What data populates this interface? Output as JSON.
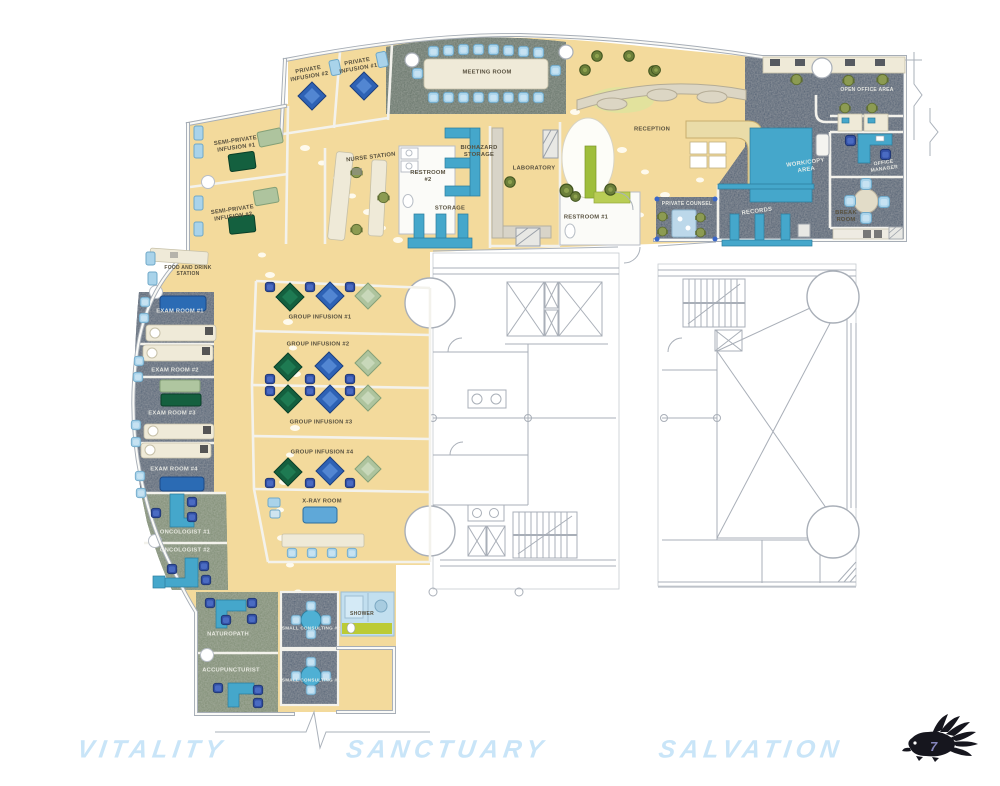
{
  "title": "Clinic Floor Plan",
  "labels": [
    {
      "id": "private-infusion-2",
      "text": "PRIVATE\nINFUSION #2",
      "x": 309,
      "y": 74,
      "rot": -10
    },
    {
      "id": "private-infusion-1",
      "text": "PRIVATE\nINFUSION #1",
      "x": 358,
      "y": 66,
      "rot": -10
    },
    {
      "id": "meeting-room",
      "text": "MEETING ROOM",
      "x": 487,
      "y": 73
    },
    {
      "id": "semi-private-infusion-1",
      "text": "SEMI-PRIVATE\nINFUSION #1",
      "x": 236,
      "y": 145,
      "rot": -8
    },
    {
      "id": "semi-private-infusion-2",
      "text": "SEMI-PRIVATE\nINFUSION #2",
      "x": 233,
      "y": 214,
      "rot": -8
    },
    {
      "id": "nurse-station",
      "text": "NURSE STATION",
      "x": 371,
      "y": 158,
      "rot": -7
    },
    {
      "id": "restroom-2",
      "text": "RESTROOM\n#2",
      "x": 428,
      "y": 177
    },
    {
      "id": "biohazard-storage",
      "text": "BIOHAZARD\nSTORAGE",
      "x": 479,
      "y": 152
    },
    {
      "id": "storage",
      "text": "STORAGE",
      "x": 450,
      "y": 209
    },
    {
      "id": "laboratory",
      "text": "LABORATORY",
      "x": 534,
      "y": 169
    },
    {
      "id": "restroom-1",
      "text": "RESTROOM #1",
      "x": 586,
      "y": 218
    },
    {
      "id": "reception",
      "text": "RECEPTION",
      "x": 652,
      "y": 130
    },
    {
      "id": "private-counsel",
      "text": "PRIVATE COUNSEL",
      "x": 687,
      "y": 204,
      "light": true,
      "size": 5
    },
    {
      "id": "records",
      "text": "RECORDS",
      "x": 757,
      "y": 212,
      "rot": -8,
      "light": true
    },
    {
      "id": "work-copy-area",
      "text": "WORK/COPY\nAREA",
      "x": 806,
      "y": 167,
      "rot": -8,
      "light": true
    },
    {
      "id": "open-office-area",
      "text": "OPEN OFFICE AREA",
      "x": 867,
      "y": 90,
      "light": true,
      "size": 5
    },
    {
      "id": "office-manager",
      "text": "OFFICE\nMANAGER",
      "x": 884,
      "y": 166,
      "rot": -8,
      "light": true,
      "size": 5
    },
    {
      "id": "break-room",
      "text": "BREAK\nROOM",
      "x": 846,
      "y": 217
    },
    {
      "id": "food-drink-station",
      "text": "FOOD AND DRINK\nSTATION",
      "x": 188,
      "y": 271,
      "size": 5
    },
    {
      "id": "exam-room-1",
      "text": "EXAM ROOM #1",
      "x": 180,
      "y": 312,
      "light": true
    },
    {
      "id": "exam-room-2",
      "text": "EXAM ROOM #2",
      "x": 175,
      "y": 371,
      "light": true
    },
    {
      "id": "exam-room-3",
      "text": "EXAM ROOM #3",
      "x": 172,
      "y": 414,
      "light": true
    },
    {
      "id": "exam-room-4",
      "text": "EXAM ROOM #4",
      "x": 174,
      "y": 470,
      "light": true
    },
    {
      "id": "oncologist-1",
      "text": "ONCOLOGIST #1",
      "x": 185,
      "y": 533,
      "light": true
    },
    {
      "id": "oncologist-2",
      "text": "ONCOLOGIST #2",
      "x": 185,
      "y": 551,
      "light": true
    },
    {
      "id": "group-infusion-1",
      "text": "GROUP INFUSION #1",
      "x": 320,
      "y": 318
    },
    {
      "id": "group-infusion-2",
      "text": "GROUP INFUSION #2",
      "x": 318,
      "y": 345
    },
    {
      "id": "group-infusion-3",
      "text": "GROUP INFUSION #3",
      "x": 321,
      "y": 423
    },
    {
      "id": "group-infusion-4",
      "text": "GROUP INFUSION #4",
      "x": 322,
      "y": 453
    },
    {
      "id": "x-ray-room",
      "text": "X-RAY ROOM",
      "x": 322,
      "y": 502
    },
    {
      "id": "naturopath",
      "text": "NATUROPATH",
      "x": 228,
      "y": 635,
      "light": true
    },
    {
      "id": "accupuncturist",
      "text": "ACCUPUNCTURIST",
      "x": 231,
      "y": 671,
      "light": true
    },
    {
      "id": "small-consulting-2",
      "text": "SMALL CONSULTING #2",
      "x": 311,
      "y": 628,
      "light": true,
      "size": 4.6
    },
    {
      "id": "small-consulting-1",
      "text": "SMALL CONSULTING #1",
      "x": 311,
      "y": 680,
      "light": true,
      "size": 4.6
    },
    {
      "id": "shower",
      "text": "SHOWER",
      "x": 362,
      "y": 614,
      "size": 5
    }
  ],
  "zone_words": [
    {
      "id": "vitality",
      "text": "VITALITY",
      "x": 152,
      "y": 750
    },
    {
      "id": "sanctuary",
      "text": "SANCTUARY",
      "x": 447,
      "y": 750
    },
    {
      "id": "salvation",
      "text": "SALVATION",
      "x": 751,
      "y": 750
    }
  ],
  "page_marker": {
    "number": "7"
  },
  "colors": {
    "floor": "#f3da9c",
    "slate": "#4e5e73",
    "sage": "#7b8a70",
    "meeting": "#5f6f63",
    "teal": "#45a7cb",
    "accent_blue": "#2e62b5",
    "dark_green": "#14603f",
    "light_green": "#b2c8a2",
    "olive": "#8c9b52",
    "light_blue": "#a9d3ea",
    "zone_text": "#c9e5f8",
    "counter": "#efead8",
    "wall": "#a6adb6"
  }
}
